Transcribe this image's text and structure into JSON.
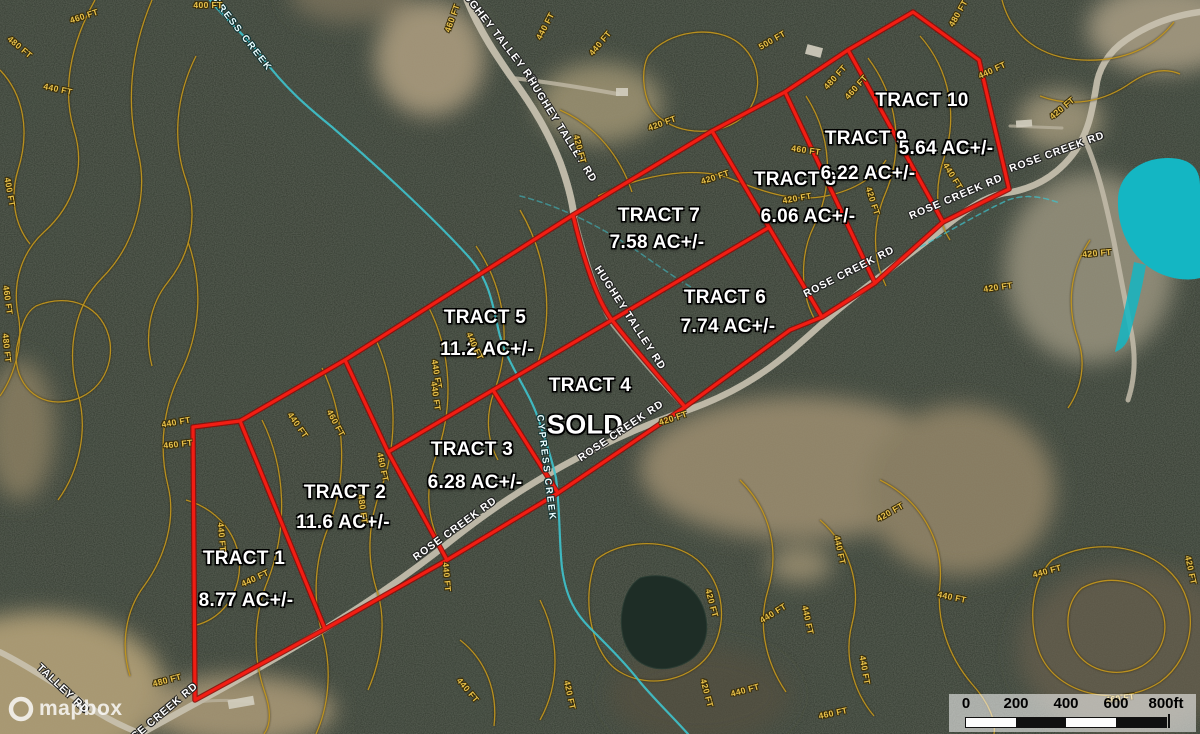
{
  "tracts": [
    {
      "name": "TRACT 1",
      "acreage": "8.77 AC+/-"
    },
    {
      "name": "TRACT 2",
      "acreage": "11.6 AC+/-"
    },
    {
      "name": "TRACT 3",
      "acreage": "6.28 AC+/-"
    },
    {
      "name": "TRACT 4",
      "status": "SOLD"
    },
    {
      "name": "TRACT 5",
      "acreage": "11.2 AC+/-"
    },
    {
      "name": "TRACT 6",
      "acreage": "7.74 AC+/-"
    },
    {
      "name": "TRACT 7",
      "acreage": "7.58 AC+/-"
    },
    {
      "name": "TRACT 8",
      "acreage": "6.06 AC+/-"
    },
    {
      "name": "TRACT 9",
      "acreage": "6.22 AC+/-"
    },
    {
      "name": "TRACT 10",
      "acreage": "5.64 AC+/-"
    }
  ],
  "roads": {
    "rose_creek": "ROSE CREEK RD",
    "hughey_talley": "HUGHEY TALLEY RD",
    "talley": "TALLEY RD"
  },
  "water": {
    "creek": "CYPRESS CREEK"
  },
  "contours": {
    "c400": "400 FT",
    "c420": "420 FT",
    "c440": "440 FT",
    "c460": "460 FT",
    "c480": "480 FT",
    "c500": "500 FT"
  },
  "scale_bar": {
    "labels": [
      "0",
      "200",
      "400",
      "600"
    ],
    "end": "800ft"
  },
  "attribution": {
    "brand": "mapbox"
  },
  "colors": {
    "boundary": "#f21d13",
    "contour": "#bf941e",
    "water": "#2fc2cd",
    "pond": "#14b6c3",
    "label": "#ffffff"
  }
}
